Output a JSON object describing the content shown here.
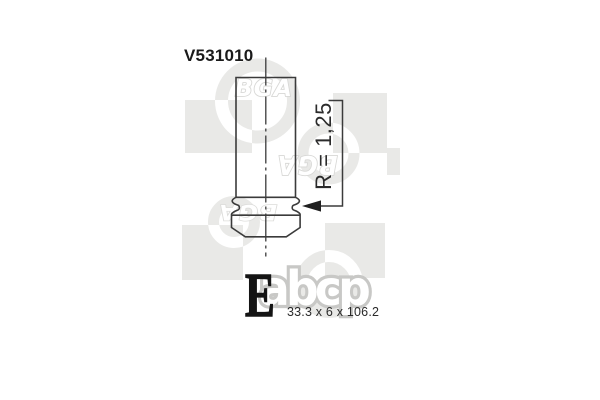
{
  "part": {
    "number": "V531010",
    "radius_annotation": "R = 1,25",
    "dimensions_label": "33.3 x 6 x 106.2"
  },
  "branding": {
    "logo_letter": "E",
    "marketplace_watermark": "abcp",
    "brand_watermark_text": "BGA"
  },
  "colors": {
    "background": "#ffffff",
    "drawing_line": "#3b3b3b",
    "arrow_fill": "#1f1f1f",
    "part_number_text": "#1a1a1a",
    "annotation_text": "#2b2b2b",
    "watermark_fill": "#e9e9e7",
    "watermark_letter_gray": "#c8c8c6",
    "logo_black": "#141414"
  }
}
